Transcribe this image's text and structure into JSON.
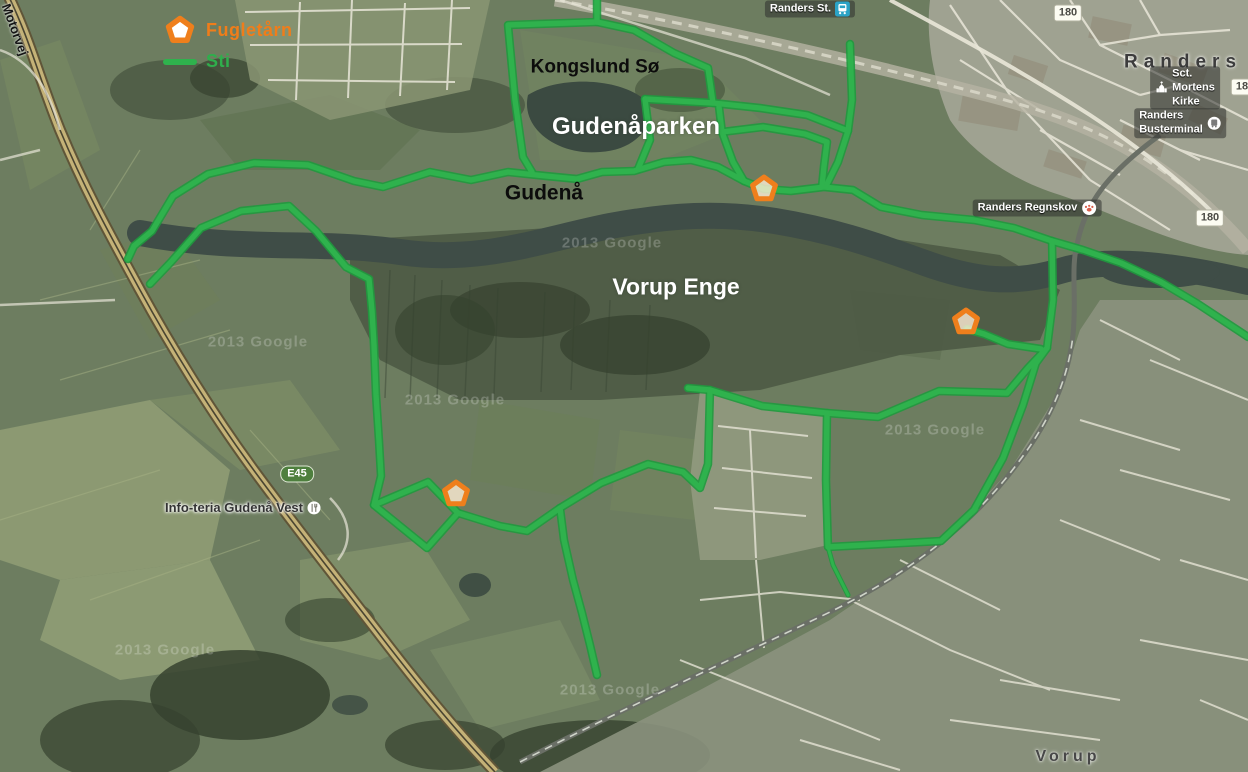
{
  "map": {
    "legend": {
      "tower_label": "Fugletårn",
      "trail_label": "Sti"
    },
    "colors": {
      "trail_green": "#2fb24d",
      "trail_outline": "#1f9a3e",
      "tower_orange": "#ef7f1c",
      "fugletaarn_text": "#ef7d1a",
      "sti_text": "#2fae4c",
      "e45_shield_green": "#4e7f3e"
    },
    "labels": [
      {
        "id": "label-motorvej",
        "text": "Motorvej",
        "x": 12,
        "y": 2,
        "cls": "road-rot",
        "size": 13,
        "rotate": 70
      },
      {
        "id": "label-kongslund-soe",
        "text": "Kongslund Sø",
        "x": 595,
        "y": 67,
        "cls": "black-bold",
        "size": 19
      },
      {
        "id": "label-gudenaaparken",
        "text": "Gudenåparken",
        "x": 636,
        "y": 127,
        "cls": "white-bold",
        "size": 24
      },
      {
        "id": "label-gudenaa",
        "text": "Gudenå",
        "x": 544,
        "y": 193,
        "cls": "black-bold",
        "size": 21
      },
      {
        "id": "label-vorup-enge",
        "text": "Vorup Enge",
        "x": 676,
        "y": 287,
        "cls": "white-bold",
        "size": 23
      },
      {
        "id": "label-randers",
        "text": "Randers",
        "x": 1183,
        "y": 62,
        "cls": "city",
        "size": 19
      },
      {
        "id": "label-vorup",
        "text": "Vorup",
        "x": 1068,
        "y": 757,
        "cls": "city small",
        "size": 16
      }
    ],
    "pois": [
      {
        "id": "poi-randers-st",
        "text": "Randers St.",
        "x": 810,
        "y": 9,
        "icon": "train",
        "icon_side": "right",
        "light": false
      },
      {
        "id": "poi-sct-mortens-kirke",
        "text": "Sct. Mortens Kirke",
        "x": 1185,
        "y": 88,
        "icon": "church",
        "icon_side": "left",
        "light": false
      },
      {
        "id": "poi-randers-busterminal",
        "text": "Randers Busterminal",
        "x": 1180,
        "y": 123,
        "icon": "bus",
        "icon_side": "right",
        "light": false
      },
      {
        "id": "poi-randers-regnskov",
        "text": "Randers Regnskov",
        "x": 1037,
        "y": 208,
        "icon": "paw",
        "icon_side": "right",
        "light": false
      },
      {
        "id": "poi-infoteria",
        "text": "Info-teria Gudenå Vest",
        "x": 243,
        "y": 508,
        "icon": "restaurant",
        "icon_side": "right",
        "light": true
      }
    ],
    "shields": [
      {
        "text": "E45",
        "x": 297,
        "y": 474,
        "kind": "motorway"
      },
      {
        "text": "180",
        "x": 1210,
        "y": 218,
        "kind": "secondary"
      },
      {
        "text": "180",
        "x": 1068,
        "y": 13,
        "kind": "secondary"
      },
      {
        "text": "180",
        "x": 1245,
        "y": 87,
        "kind": "secondary"
      }
    ],
    "watermarks": [
      {
        "text": "2013 Google",
        "x": 612,
        "y": 243
      },
      {
        "text": "2013 Google",
        "x": 455,
        "y": 400
      },
      {
        "text": "2013 Google",
        "x": 935,
        "y": 430
      },
      {
        "text": "2013 Google",
        "x": 610,
        "y": 690
      },
      {
        "text": "2013 Google",
        "x": 165,
        "y": 650
      },
      {
        "text": "2013 Google",
        "x": 258,
        "y": 342
      }
    ],
    "towers": [
      {
        "id": "tower-gudenaaparken",
        "x": 764,
        "y": 189
      },
      {
        "id": "tower-vorup-enge-east",
        "x": 966,
        "y": 322
      },
      {
        "id": "tower-vorup-enge-west",
        "x": 456,
        "y": 494
      }
    ],
    "trails": [
      {
        "id": "trail-north-bank",
        "thin": false,
        "points": [
          [
            128,
            259
          ],
          [
            134,
            246
          ],
          [
            152,
            231
          ],
          [
            173,
            196
          ],
          [
            208,
            174
          ],
          [
            254,
            163
          ],
          [
            308,
            165
          ],
          [
            354,
            181
          ],
          [
            383,
            187
          ],
          [
            430,
            172
          ],
          [
            471,
            180
          ],
          [
            508,
            172
          ],
          [
            546,
            176
          ],
          [
            577,
            179
          ],
          [
            602,
            172
          ],
          [
            634,
            171
          ],
          [
            664,
            162
          ],
          [
            691,
            160
          ],
          [
            718,
            167
          ],
          [
            744,
            181
          ],
          [
            764,
            189
          ],
          [
            791,
            191
          ],
          [
            824,
            187
          ],
          [
            853,
            190
          ],
          [
            881,
            207
          ],
          [
            922,
            215
          ],
          [
            974,
            220
          ],
          [
            1014,
            228
          ],
          [
            1052,
            241
          ]
        ]
      },
      {
        "id": "trail-east-riverside",
        "thin": false,
        "points": [
          [
            1052,
            241
          ],
          [
            1083,
            250
          ],
          [
            1121,
            263
          ],
          [
            1161,
            282
          ],
          [
            1198,
            304
          ],
          [
            1248,
            337
          ]
        ]
      },
      {
        "id": "trail-river-crossing",
        "thin": false,
        "points": [
          [
            1052,
            241
          ],
          [
            1053,
            300
          ],
          [
            1047,
            348
          ]
        ]
      },
      {
        "id": "trail-east-loop",
        "thin": false,
        "points": [
          [
            1047,
            348
          ],
          [
            1036,
            363
          ],
          [
            1023,
            405
          ],
          [
            1003,
            458
          ],
          [
            974,
            510
          ],
          [
            941,
            541
          ],
          [
            828,
            547
          ],
          [
            826,
            480
          ],
          [
            827,
            413
          ],
          [
            878,
            417
          ],
          [
            939,
            391
          ],
          [
            1007,
            393
          ],
          [
            1028,
            368
          ],
          [
            1047,
            348
          ]
        ]
      },
      {
        "id": "trail-tower-east-spur",
        "thin": false,
        "points": [
          [
            967,
            329
          ],
          [
            984,
            334
          ],
          [
            1008,
            344
          ],
          [
            1041,
            349
          ]
        ]
      },
      {
        "id": "trail-vorup-west-link",
        "thin": false,
        "points": [
          [
            688,
            388
          ],
          [
            710,
            390
          ],
          [
            762,
            406
          ],
          [
            827,
            413
          ]
        ]
      },
      {
        "id": "trail-diamond-link",
        "thin": false,
        "points": [
          [
            458,
            513
          ],
          [
            500,
            526
          ],
          [
            527,
            531
          ],
          [
            560,
            508
          ],
          [
            601,
            483
          ],
          [
            648,
            464
          ],
          [
            683,
            472
          ],
          [
            700,
            488
          ],
          [
            708,
            464
          ],
          [
            710,
            390
          ]
        ]
      },
      {
        "id": "trail-diamond-loop",
        "thin": false,
        "points": [
          [
            374,
            505
          ],
          [
            428,
            482
          ],
          [
            458,
            513
          ],
          [
            427,
            548
          ],
          [
            374,
            505
          ]
        ]
      },
      {
        "id": "trail-south-spur",
        "thin": false,
        "points": [
          [
            560,
            508
          ],
          [
            564,
            540
          ],
          [
            573,
            580
          ],
          [
            582,
            613
          ],
          [
            590,
            645
          ],
          [
            597,
            675
          ]
        ]
      },
      {
        "id": "trail-southeast-stub",
        "thin": true,
        "points": [
          [
            828,
            547
          ],
          [
            833,
            565
          ],
          [
            841,
            581
          ],
          [
            848,
            595
          ]
        ]
      },
      {
        "id": "trail-inner-meadow",
        "thin": false,
        "points": [
          [
            150,
            284
          ],
          [
            171,
            262
          ],
          [
            201,
            228
          ],
          [
            241,
            211
          ],
          [
            289,
            206
          ],
          [
            316,
            231
          ],
          [
            346,
            267
          ],
          [
            369,
            279
          ],
          [
            372,
            311
          ],
          [
            374,
            345
          ],
          [
            376,
            395
          ],
          [
            379,
            441
          ],
          [
            381,
            476
          ],
          [
            374,
            505
          ]
        ]
      },
      {
        "id": "trail-kongslund-loop",
        "thin": false,
        "points": [
          [
            597,
            0
          ],
          [
            597,
            22
          ],
          [
            508,
            25
          ],
          [
            515,
            100
          ],
          [
            523,
            157
          ],
          [
            532,
            172
          ]
        ]
      },
      {
        "id": "trail-park-diagonal",
        "thin": false,
        "points": [
          [
            597,
            22
          ],
          [
            634,
            30
          ],
          [
            674,
            53
          ],
          [
            708,
            68
          ],
          [
            713,
            103
          ]
        ]
      },
      {
        "id": "trail-park-cross",
        "thin": false,
        "points": [
          [
            645,
            99
          ],
          [
            713,
            103
          ],
          [
            760,
            108
          ],
          [
            807,
            115
          ],
          [
            848,
            131
          ]
        ]
      },
      {
        "id": "trail-park-connector",
        "thin": false,
        "points": [
          [
            645,
            99
          ],
          [
            650,
            140
          ],
          [
            638,
            169
          ]
        ]
      },
      {
        "id": "trail-northeast-link",
        "thin": false,
        "points": [
          [
            850,
            44
          ],
          [
            852,
            100
          ],
          [
            848,
            131
          ],
          [
            838,
            162
          ],
          [
            826,
            186
          ]
        ]
      },
      {
        "id": "trail-pit-west",
        "thin": false,
        "points": [
          [
            719,
            107
          ],
          [
            722,
            132
          ],
          [
            733,
            162
          ],
          [
            744,
            181
          ]
        ]
      },
      {
        "id": "trail-pit-east",
        "thin": false,
        "points": [
          [
            722,
            132
          ],
          [
            763,
            127
          ],
          [
            805,
            134
          ],
          [
            827,
            142
          ],
          [
            824,
            166
          ],
          [
            822,
            186
          ]
        ]
      }
    ]
  }
}
